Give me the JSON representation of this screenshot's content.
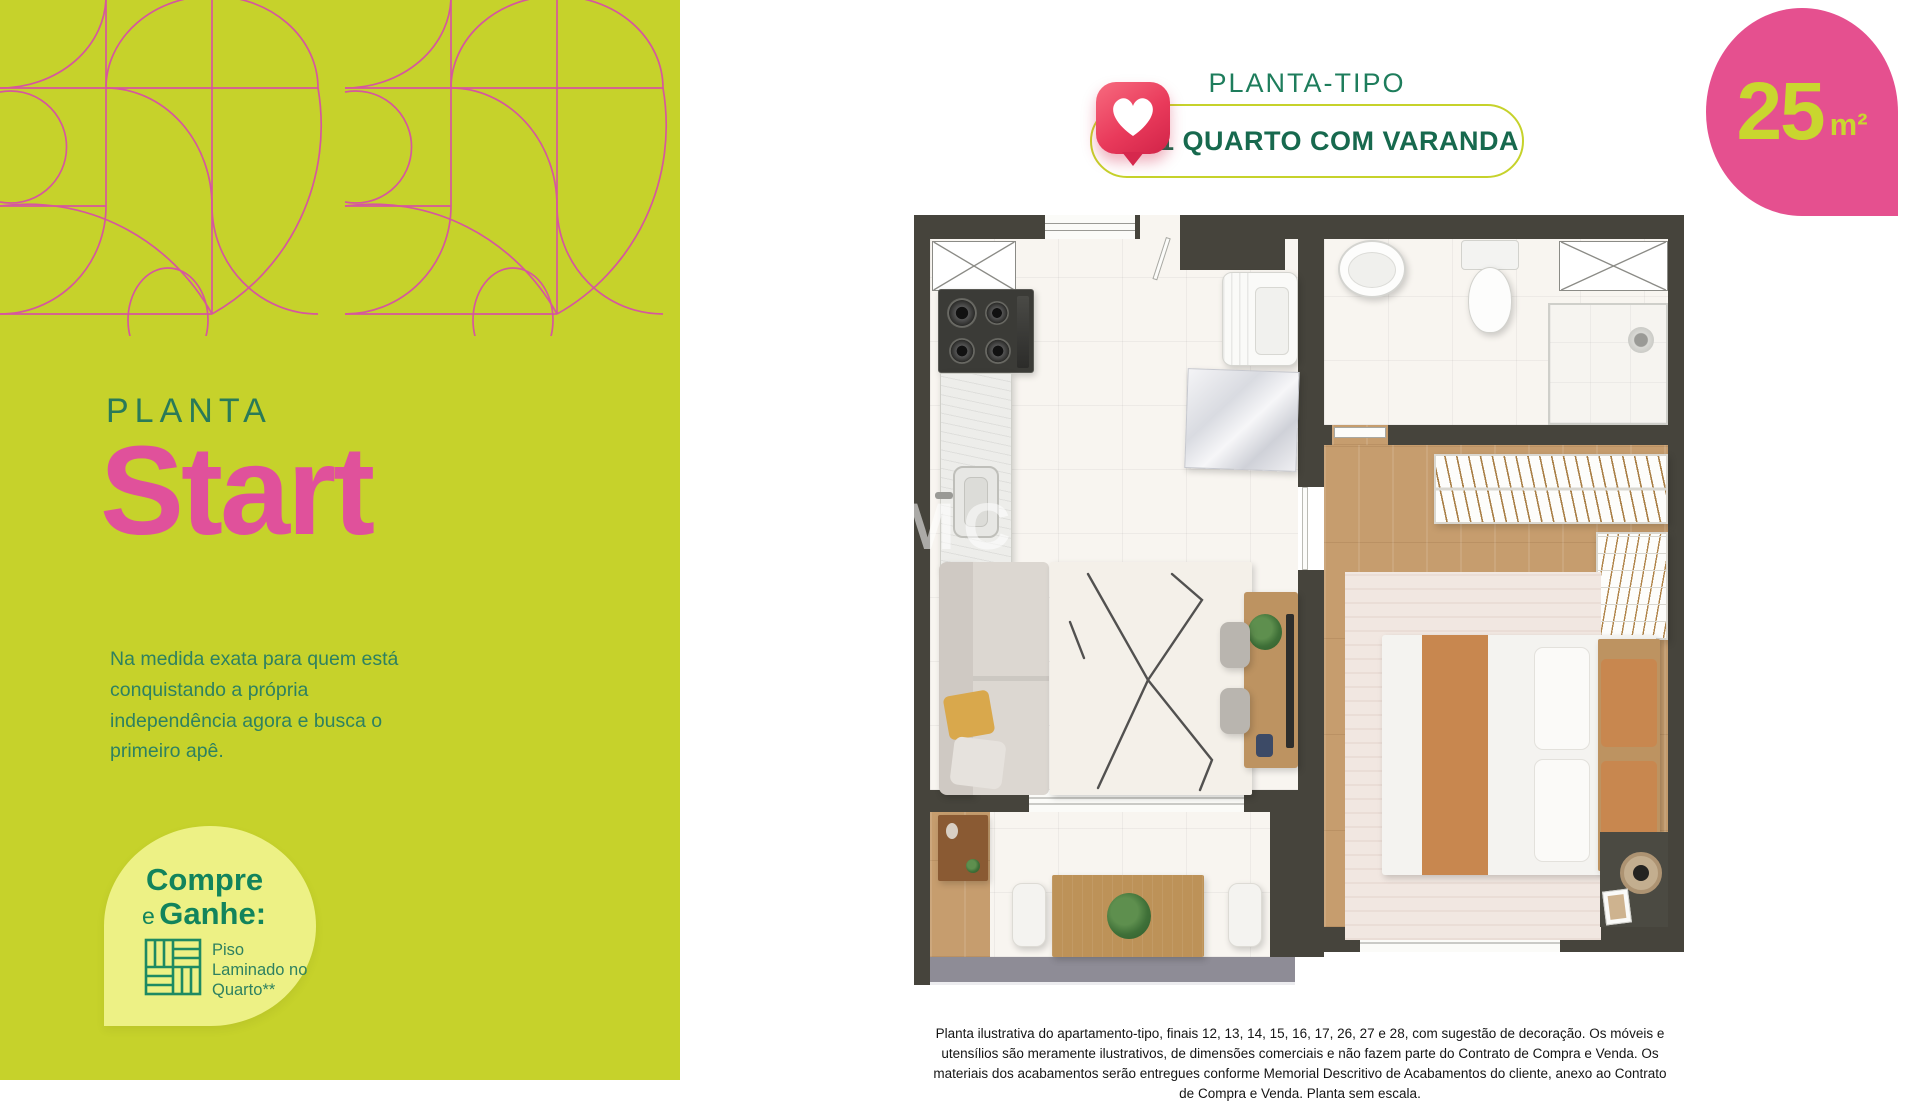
{
  "left_panel": {
    "kicker": "PLANTA",
    "title": "Start",
    "description": "Na medida exata para quem está conquistando a própria independência agora e busca o primeiro apê.",
    "promo": {
      "line1": "Compre",
      "line2_small": "e",
      "line2": "Ganhe:",
      "gift_label": "Piso Laminado no Quarto**",
      "gift_icon": "laminate-floor-icon"
    }
  },
  "header": {
    "kicker": "PLANTA-TIPO",
    "badge_label": "1 QUARTO COM VARANDA",
    "badge_icon": "like-heart-icon"
  },
  "area_tag": {
    "value": "25",
    "unit": "m²"
  },
  "floorplan": {
    "watermark": "MC"
  },
  "disclaimer": "Planta ilustrativa do apartamento-tipo, finais 12, 13, 14, 15, 16, 17, 26, 27 e 28, com sugestão de decoração. Os móveis e utensílios são meramente ilustrativos, de dimensões comerciais e não fazem parte do Contrato de Compra e Venda. Os materiais dos acabamentos serão entregues conforme Memorial Descritivo de Acabamentos do cliente, anexo ao Contrato de Compra e Venda. Planta sem escala.",
  "colors": {
    "lime": "#C6D22B",
    "pattern_pink": "#D6579E",
    "title_pink": "#E0519B",
    "teal_dark": "#17694E",
    "teal": "#2E8160",
    "blob_pink": "#E5508F",
    "wall": "#46443C",
    "wood": "#C69D6E",
    "promo_bg": "#EDF185"
  }
}
